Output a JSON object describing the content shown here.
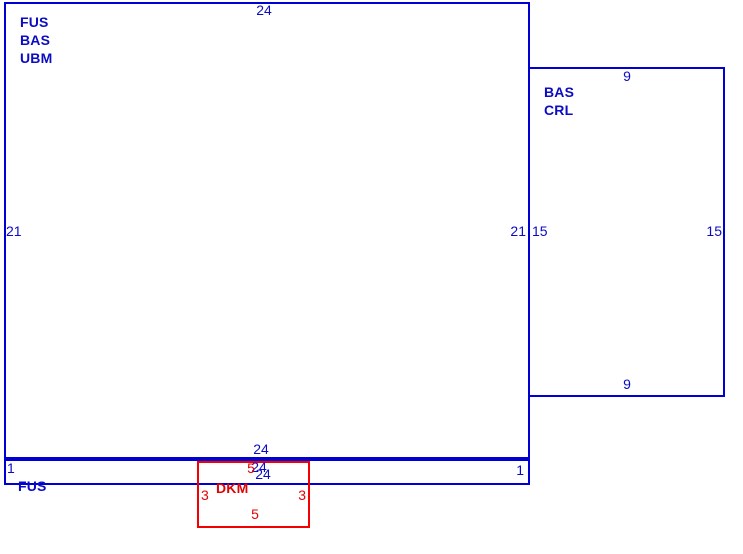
{
  "diagram": {
    "type": "rectangle-layout",
    "colors": {
      "panel_outline": "#0000d4",
      "panel_text": "#0b0bc4",
      "item_outline": "#f40000",
      "item_text": "#e00404",
      "background": "#ffffff"
    },
    "panels": {
      "main": {
        "names": [
          "FUS",
          "BAS",
          "UBM"
        ],
        "dim_top": "24",
        "dim_bottom": "24",
        "dim_left": "21",
        "dim_right": "21"
      },
      "side": {
        "names": [
          "BAS",
          "CRL"
        ],
        "dim_top": "9",
        "dim_bottom": "9",
        "dim_left": "15",
        "dim_right": "15"
      },
      "strip": {
        "names": [
          "FUS"
        ],
        "dim_top": "24",
        "dim_bottom": "24",
        "dim_left": "1",
        "dim_right": "1"
      },
      "dkm": {
        "names": [
          "DKM"
        ],
        "dim_top": "5",
        "dim_bottom": "5",
        "dim_left": "3",
        "dim_right": "3"
      }
    }
  }
}
